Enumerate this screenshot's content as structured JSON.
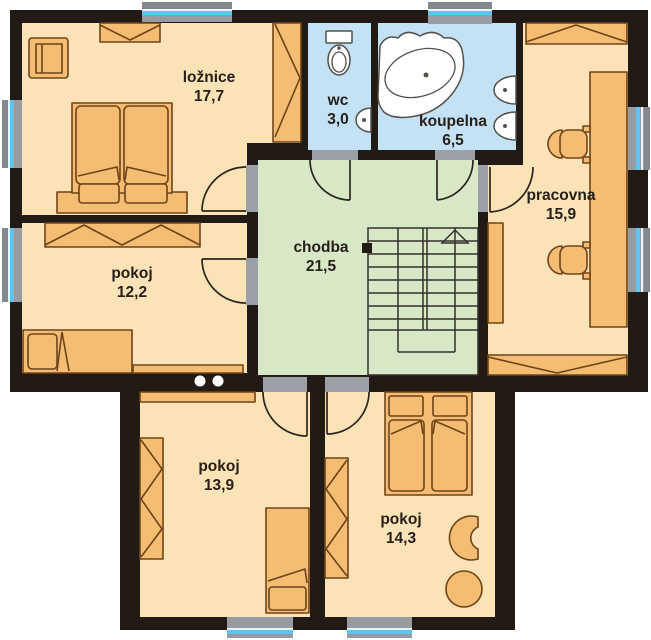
{
  "title": "First floor plan",
  "rooms": [
    {
      "id": "loznice",
      "name": "ložnice",
      "area": "17,7"
    },
    {
      "id": "wc",
      "name": "wc",
      "area": "3,0"
    },
    {
      "id": "koupelna",
      "name": "koupelna",
      "area": "6,5"
    },
    {
      "id": "pracovna",
      "name": "pracovna",
      "area": "15,9"
    },
    {
      "id": "chodba",
      "name": "chodba",
      "area": "21,5"
    },
    {
      "id": "pokoj-west",
      "name": "pokoj",
      "area": "12,2"
    },
    {
      "id": "pokoj-south-west",
      "name": "pokoj",
      "area": "13,9"
    },
    {
      "id": "pokoj-south",
      "name": "pokoj",
      "area": "14,3"
    }
  ],
  "colors": {
    "wall": "#221b15",
    "room_peach": "#fbe3b7",
    "room_blue": "#c3e2f5",
    "room_green": "#d8e8c7",
    "furniture_orange": "#f5bc74",
    "furniture_outline": "#6e4418",
    "window_glass_blue": "#5fc4f0",
    "window_frame_gray": "#969ca2",
    "threshold_gray": "#9ba1a7",
    "fixture_white": "#ffffff"
  }
}
